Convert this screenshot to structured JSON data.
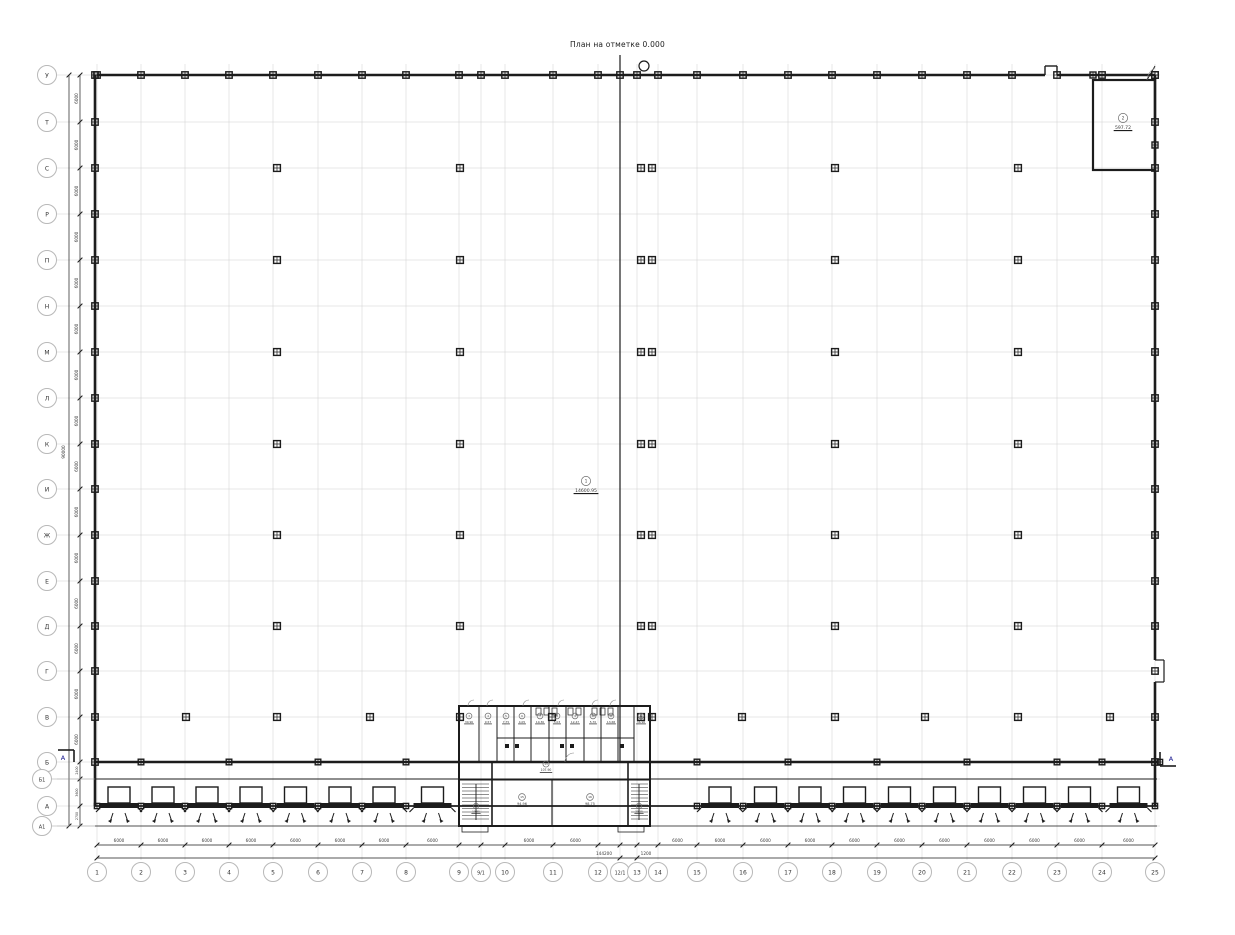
{
  "title": "План на отметке 0.000",
  "axes": {
    "rows": [
      "У",
      "Т",
      "С",
      "Р",
      "П",
      "Н",
      "М",
      "Л",
      "К",
      "И",
      "Ж",
      "Е",
      "Д",
      "Г",
      "В",
      "Б",
      "Б1",
      "А",
      "А1"
    ],
    "cols": [
      "1",
      "2",
      "3",
      "4",
      "5",
      "6",
      "7",
      "8",
      "9",
      "9/1",
      "10",
      "11",
      "12",
      "12/1",
      "13",
      "14",
      "15",
      "16",
      "17",
      "18",
      "19",
      "20",
      "21",
      "22",
      "23",
      "24",
      "25"
    ]
  },
  "dimensions": {
    "bay_width": "6000",
    "bay_height": "6000",
    "overall_width": "144200",
    "joint_bay": "1200",
    "overall_height": "90000",
    "lower_rows": [
      "2400",
      "3600",
      "2700"
    ]
  },
  "section_marks": {
    "left": "А",
    "right": "А"
  },
  "rooms": {
    "hall": {
      "num": "1",
      "area": "14600.95"
    },
    "corner_room": {
      "num": "2",
      "area": "597.72"
    },
    "small_rooms": [
      {
        "num": "3",
        "area": "30.96"
      },
      {
        "num": "4",
        "area": "9.57"
      },
      {
        "num": "5",
        "area": "7.75"
      },
      {
        "num": "6",
        "area": "4.05"
      },
      {
        "num": "7",
        "area": "10.36"
      },
      {
        "num": "8",
        "area": "5.03"
      },
      {
        "num": "9",
        "area": "12.47"
      },
      {
        "num": "10",
        "area": "5.70"
      },
      {
        "num": "11",
        "area": "13.68"
      },
      {
        "num": "12",
        "area": "36.96"
      }
    ],
    "entrance_block": {
      "corridor": {
        "num": "13",
        "area": "107.90"
      },
      "left_stair": {
        "num": "14",
        "area": "19.85"
      },
      "left_room": {
        "num": "15",
        "area": "94.96"
      },
      "right_room": {
        "num": "16",
        "area": "98.75"
      },
      "right_stair": {
        "num": "17",
        "area": "20.15"
      }
    }
  },
  "colors": {
    "wall": "#1c1c1c",
    "grid": "#cfcfcf",
    "axis_circle": "#b8b8b8",
    "dim_text": "#3a3a3a"
  }
}
